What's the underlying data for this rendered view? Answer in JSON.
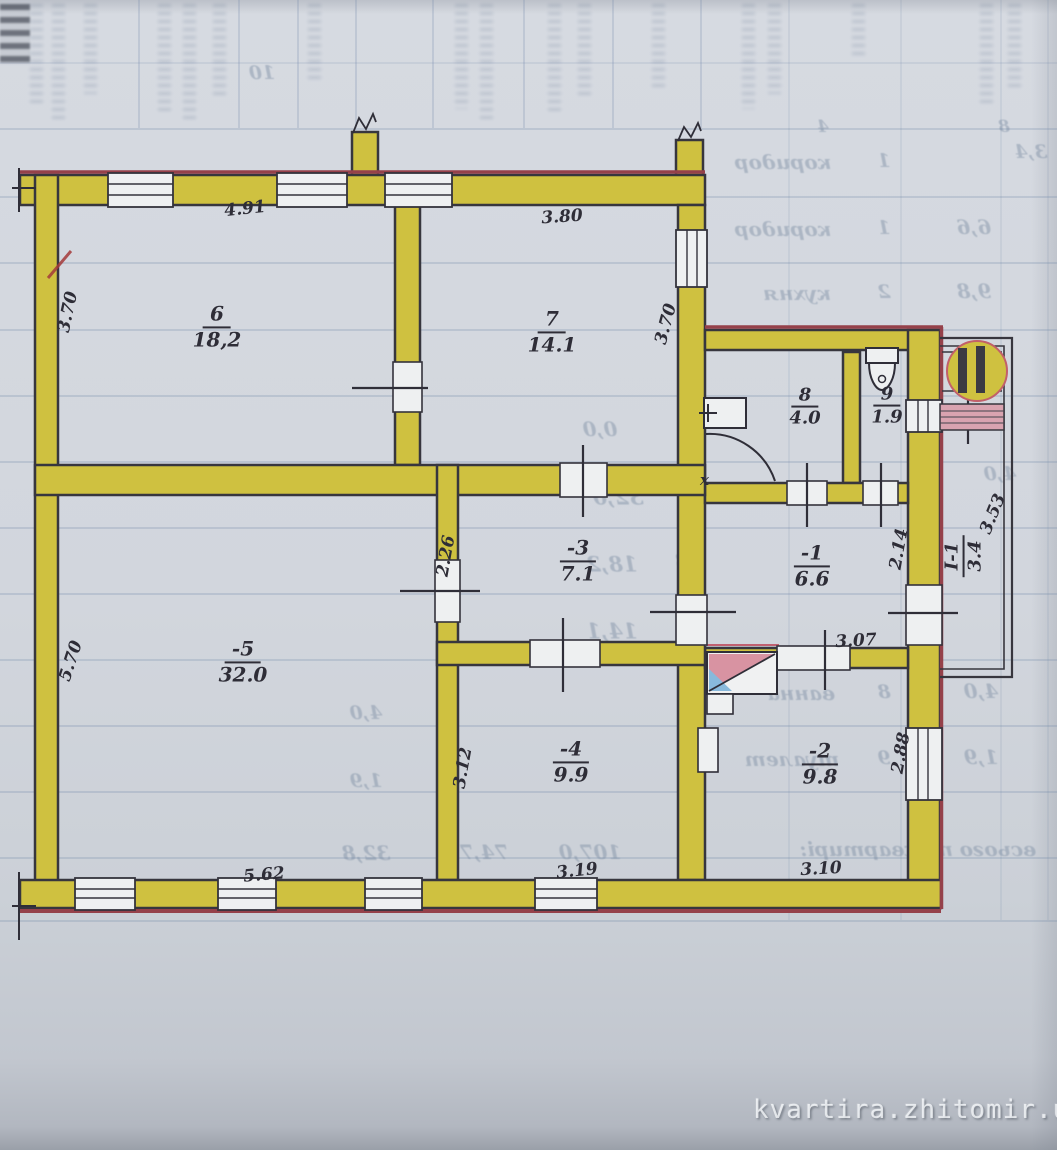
{
  "plan": {
    "rooms": [
      {
        "num": "6",
        "area": "18,2"
      },
      {
        "num": "7",
        "area": "14.1"
      },
      {
        "num": "8",
        "area": "4.0"
      },
      {
        "num": "9",
        "area": "1.9"
      },
      {
        "num": "-1",
        "area": "6.6"
      },
      {
        "num": "-2",
        "area": "9.8"
      },
      {
        "num": "-3",
        "area": "7.1"
      },
      {
        "num": "-4",
        "area": "9.9"
      },
      {
        "num": "-5",
        "area": "32.0"
      },
      {
        "num": "I-1",
        "area": "3.4"
      }
    ],
    "dims": [
      "4.91",
      "3.80",
      "3.70",
      "3.70",
      "2.26",
      "5.70",
      "2.14",
      "3.53",
      "3.07",
      "3.12",
      "2.88",
      "5.62",
      "3.19",
      "3.10"
    ],
    "x_mark": "х"
  },
  "ghost": {
    "rows": [
      "10",
      "4",
      "8",
      "коридор",
      "1",
      "3,4",
      "коридор",
      "1",
      "6,6",
      "кухня",
      "2",
      "9,8",
      "7,1",
      "0,0",
      "4,0",
      "32,0",
      "18,2",
      "18",
      "14,1",
      "14",
      "ванна",
      "8",
      "4,0",
      "туалет",
      "9",
      "1,9",
      "всього по квартирі:",
      "107,0",
      "74,7",
      "32,8",
      "4,0",
      "1,9"
    ]
  },
  "watermark": "kvartira.zhitomir.ua"
}
